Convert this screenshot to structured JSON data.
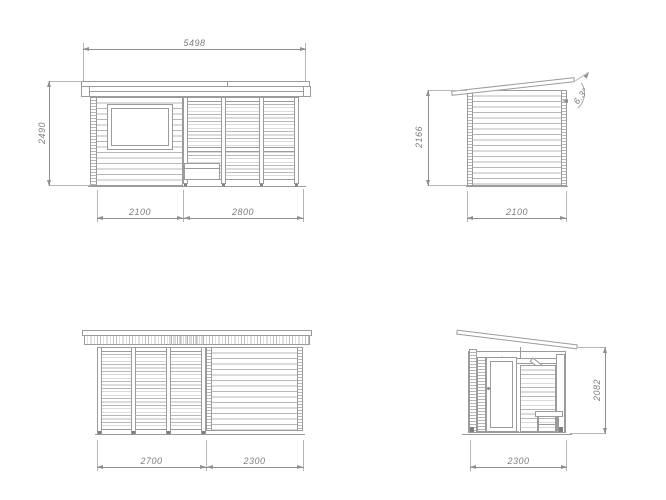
{
  "colors": {
    "line": "#9b9b9b",
    "texture": "#b7b7b7",
    "dimension_line": "#8f8f8f",
    "dimension_text": "#7d7d7d",
    "background": "#ffffff"
  },
  "views": {
    "front": {
      "total_width": "5498",
      "height": "2490",
      "section_left": "2100",
      "section_right": "2800"
    },
    "side_right": {
      "height": "2166",
      "depth": "2100",
      "roof_angle": "6.3°"
    },
    "rear": {
      "section_left": "2700",
      "section_right": "2300"
    },
    "side_left": {
      "depth": "2300",
      "height": "2082"
    }
  }
}
